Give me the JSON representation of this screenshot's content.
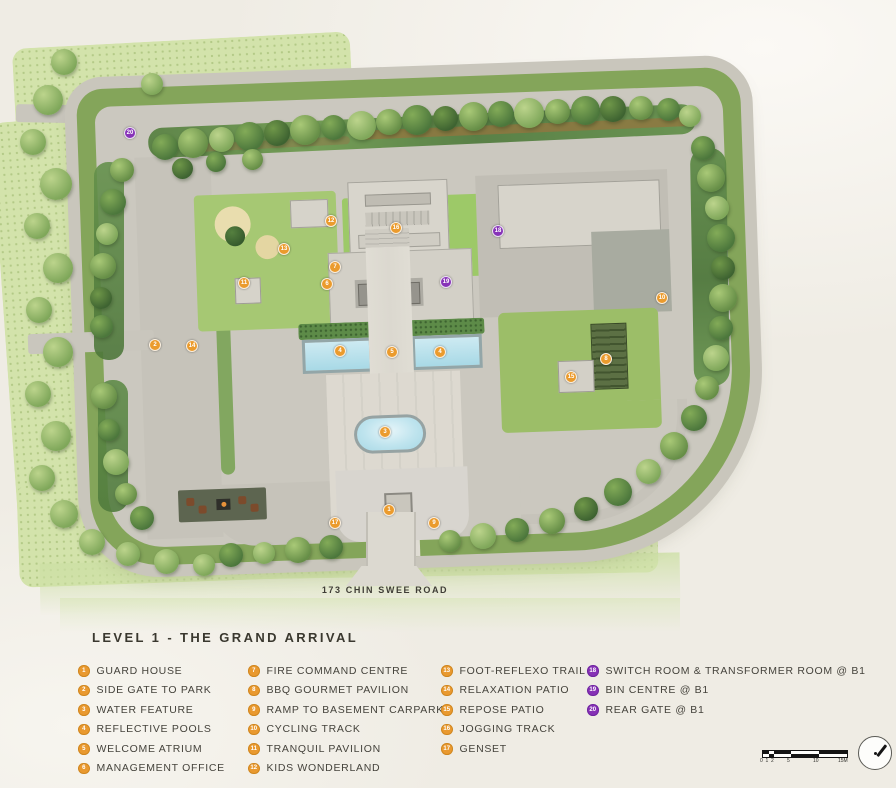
{
  "title": "LEVEL 1 - THE GRAND ARRIVAL",
  "road_label": "173 CHIN SWEE ROAD",
  "colors": {
    "marker_orange": "#EB9B2D",
    "marker_purple": "#8733B8",
    "park_green": "#D3E3AB",
    "pool_blue": "#B8E0EA",
    "road_gray": "#C9C6BC"
  },
  "legend": {
    "columns": [
      {
        "items": [
          {
            "num": "1",
            "label": "GUARD HOUSE",
            "badge": "orange"
          },
          {
            "num": "2",
            "label": "SIDE GATE TO PARK",
            "badge": "orange"
          },
          {
            "num": "3",
            "label": "WATER FEATURE",
            "badge": "orange"
          },
          {
            "num": "4",
            "label": "REFLECTIVE POOLS",
            "badge": "orange"
          },
          {
            "num": "5",
            "label": "WELCOME ATRIUM",
            "badge": "orange"
          },
          {
            "num": "6",
            "label": "MANAGEMENT OFFICE",
            "badge": "orange"
          }
        ]
      },
      {
        "items": [
          {
            "num": "7",
            "label": "FIRE COMMAND CENTRE",
            "badge": "orange"
          },
          {
            "num": "8",
            "label": "BBQ GOURMET PAVILION",
            "badge": "orange"
          },
          {
            "num": "9",
            "label": "RAMP TO BASEMENT CARPARK",
            "badge": "orange"
          },
          {
            "num": "10",
            "label": "CYCLING TRACK",
            "badge": "orange"
          },
          {
            "num": "11",
            "label": "TRANQUIL PAVILION",
            "badge": "orange"
          },
          {
            "num": "12",
            "label": "KIDS WONDERLAND",
            "badge": "orange"
          }
        ]
      },
      {
        "items": [
          {
            "num": "13",
            "label": "FOOT-REFLEXO TRAIL",
            "badge": "orange"
          },
          {
            "num": "14",
            "label": "RELAXATION PATIO",
            "badge": "orange"
          },
          {
            "num": "15",
            "label": "REPOSE PATIO",
            "badge": "orange"
          },
          {
            "num": "16",
            "label": "JOGGING TRACK",
            "badge": "orange"
          },
          {
            "num": "17",
            "label": "GENSET",
            "badge": "orange"
          }
        ]
      },
      {
        "items": [
          {
            "num": "18",
            "label": "SWITCH ROOM & TRANSFORMER ROOM @ B1",
            "badge": "purple"
          },
          {
            "num": "19",
            "label": "BIN CENTRE @ B1",
            "badge": "purple"
          },
          {
            "num": "20",
            "label": "REAR GATE @ B1",
            "badge": "purple"
          }
        ]
      }
    ]
  },
  "map": {
    "markers": [
      {
        "num": "20",
        "x": 130,
        "y": 133,
        "badge": "purple"
      },
      {
        "num": "12",
        "x": 331,
        "y": 221,
        "badge": "orange"
      },
      {
        "num": "16",
        "x": 396,
        "y": 228,
        "badge": "orange"
      },
      {
        "num": "18",
        "x": 498,
        "y": 231,
        "badge": "purple"
      },
      {
        "num": "13",
        "x": 284,
        "y": 249,
        "badge": "orange"
      },
      {
        "num": "7",
        "x": 335,
        "y": 267,
        "badge": "orange"
      },
      {
        "num": "6",
        "x": 327,
        "y": 284,
        "badge": "orange"
      },
      {
        "num": "11",
        "x": 244,
        "y": 283,
        "badge": "orange"
      },
      {
        "num": "19",
        "x": 446,
        "y": 282,
        "badge": "purple"
      },
      {
        "num": "10",
        "x": 662,
        "y": 298,
        "badge": "orange"
      },
      {
        "num": "2",
        "x": 155,
        "y": 345,
        "badge": "orange"
      },
      {
        "num": "14",
        "x": 192,
        "y": 346,
        "badge": "orange"
      },
      {
        "num": "4",
        "x": 340,
        "y": 351,
        "badge": "orange"
      },
      {
        "num": "5",
        "x": 392,
        "y": 352,
        "badge": "orange"
      },
      {
        "num": "4",
        "x": 440,
        "y": 352,
        "badge": "orange"
      },
      {
        "num": "8",
        "x": 606,
        "y": 359,
        "badge": "orange"
      },
      {
        "num": "15",
        "x": 571,
        "y": 377,
        "badge": "orange"
      },
      {
        "num": "3",
        "x": 385,
        "y": 432,
        "badge": "orange"
      },
      {
        "num": "1",
        "x": 389,
        "y": 510,
        "badge": "orange"
      },
      {
        "num": "17",
        "x": 335,
        "y": 523,
        "badge": "orange"
      },
      {
        "num": "9",
        "x": 434,
        "y": 523,
        "badge": "orange"
      }
    ]
  },
  "scale_bar": {
    "labels": [
      "0",
      "1",
      "2",
      "5",
      "10",
      "15M"
    ]
  },
  "compass": {
    "direction": "north-east-needle"
  }
}
